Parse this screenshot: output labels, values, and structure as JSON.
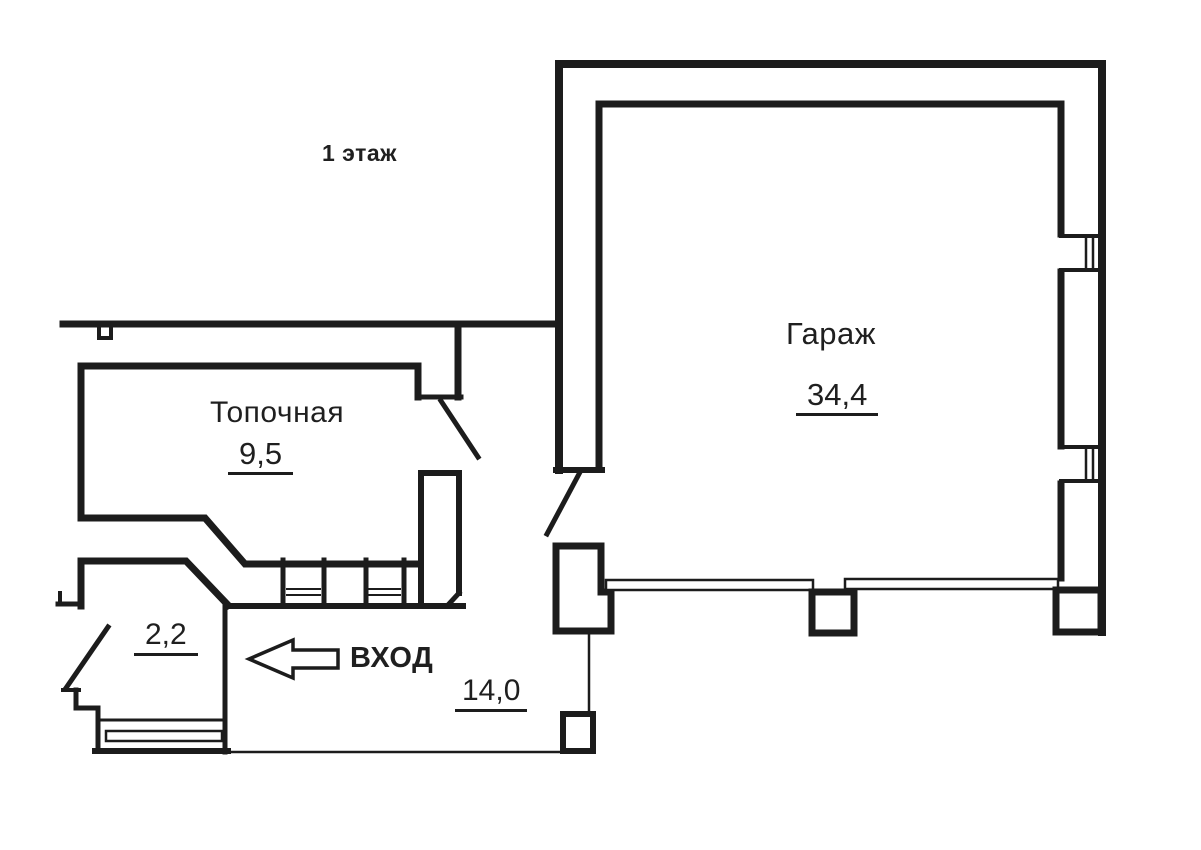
{
  "page": {
    "title": "1 этаж"
  },
  "rooms": {
    "boiler": {
      "name": "Топочная",
      "area": "9,5"
    },
    "garage": {
      "name": "Гараж",
      "area": "34,4"
    },
    "vestibule": {
      "area": "2,2"
    },
    "hall": {
      "area": "14,0"
    }
  },
  "entrance": {
    "label": "ВХОД",
    "arrow_direction": "left"
  },
  "colors": {
    "line": "#1c1c1c",
    "paper": "#ffffff",
    "text": "#1f1f1f"
  }
}
